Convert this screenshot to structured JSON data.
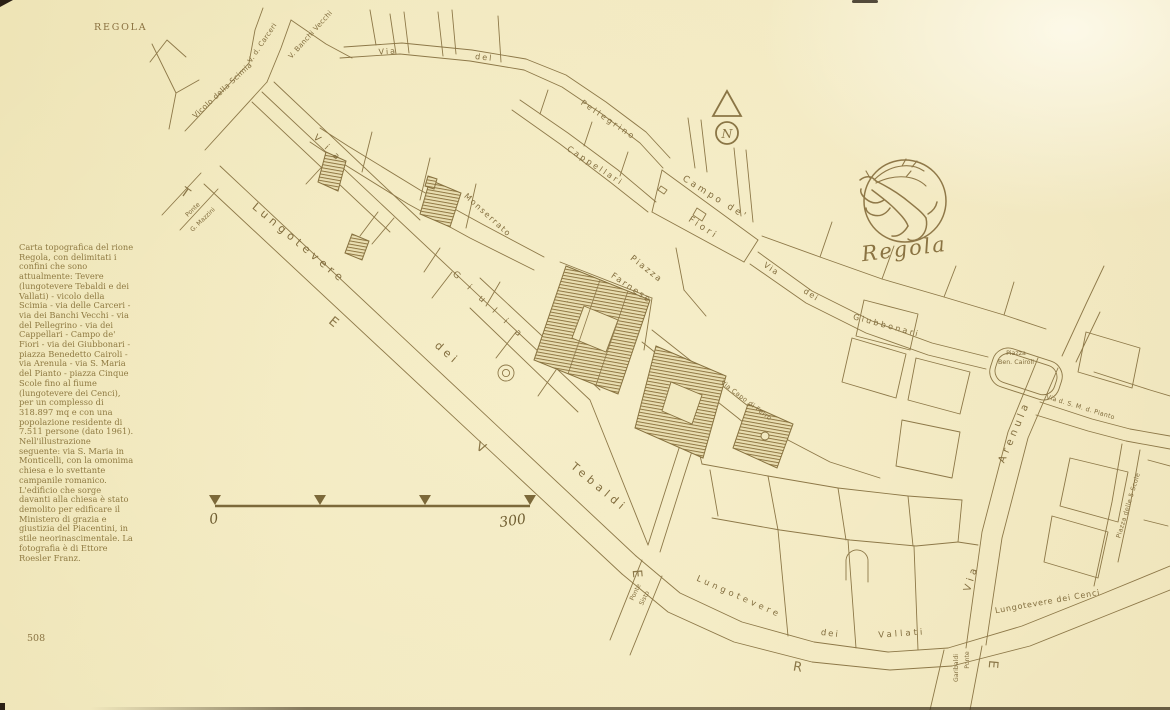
{
  "page": {
    "header": "REGOLA",
    "page_number": "508"
  },
  "sidebar": {
    "caption": "Carta topografica del rione Regola, con delimitati i confini che sono attualmente: Tevere (lungotevere Tebaldi e dei Vallati) - vicolo della Scimia - via delle Carceri - via dei Banchi Vecchi - via del Pellegrino - via dei Cappellari - Campo de' Fiori - via dei Giubbonari - piazza Benedetto Cairoli - via Arenula - via S. Maria del Pianto - piazza Cinque Scole fino al fiume (lungotevere dei Cenci), per un complesso di 318.897 mq e con una popolazione residente di 7.511 persone (dato 1961). Nell'illustrazione seguente: via S. Maria in Monticelli, con la omonima chiesa e lo svettante campanile romanico. L'edificio che sorge davanti alla chiesa è stato demolito per edificare il Ministero di grazia e giustizia del Piacentini, in stile neorinascimentale. La fotografia è di Ettore Roesler Franz."
  },
  "scale_bar": {
    "start_label": "0",
    "end_label": "300"
  },
  "compass": {
    "letter": "N"
  },
  "emblem": {
    "label": "Regola",
    "symbol": "rampant-stag"
  },
  "colors": {
    "paper": "#f2e9c0",
    "ink": "#8d7848",
    "text": "#8f7a42"
  },
  "map": {
    "labels": [
      {
        "text": "Vicolo della Scimia",
        "x": 224,
        "y": 92,
        "r": -43,
        "s": 7.5,
        "ls": 0.4
      },
      {
        "text": "V. d. Carceri",
        "x": 264,
        "y": 44,
        "r": -56,
        "s": 7,
        "ls": 0.3
      },
      {
        "text": "V. Banchi Vecchi",
        "x": 312,
        "y": 36,
        "r": -48,
        "s": 7,
        "ls": 0.3
      },
      {
        "text": "Via",
        "x": 388,
        "y": 54,
        "r": -4,
        "s": 8,
        "ls": 2
      },
      {
        "text": "del",
        "x": 484,
        "y": 60,
        "r": 6,
        "s": 8,
        "ls": 2
      },
      {
        "text": "Pellegrino",
        "x": 607,
        "y": 122,
        "r": 34,
        "s": 8,
        "ls": 2.5
      },
      {
        "text": "Cappellari",
        "x": 594,
        "y": 168,
        "r": 33,
        "s": 8,
        "ls": 2.5
      },
      {
        "text": "Monserrato",
        "x": 486,
        "y": 217,
        "r": 42,
        "s": 8,
        "ls": 1.5
      },
      {
        "text": "Via",
        "x": 328,
        "y": 152,
        "r": 43,
        "s": 9,
        "ls": 9
      },
      {
        "text": "Giulia",
        "x": 490,
        "y": 310,
        "r": 43,
        "s": 9,
        "ls": 13
      },
      {
        "text": "Campo de'",
        "x": 714,
        "y": 200,
        "r": 32,
        "s": 9,
        "ls": 3
      },
      {
        "text": "Fiori",
        "x": 702,
        "y": 230,
        "r": 33,
        "s": 9,
        "ls": 3
      },
      {
        "text": "Piazza",
        "x": 645,
        "y": 271,
        "r": 38,
        "s": 8.5,
        "ls": 2
      },
      {
        "text": "Farnese",
        "x": 630,
        "y": 290,
        "r": 34,
        "s": 8.5,
        "ls": 2
      },
      {
        "text": "Via",
        "x": 770,
        "y": 271,
        "r": 34,
        "s": 8,
        "ls": 1.5
      },
      {
        "text": "dei",
        "x": 810,
        "y": 297,
        "r": 32,
        "s": 8,
        "ls": 1.5
      },
      {
        "text": "Giubbonari",
        "x": 886,
        "y": 328,
        "r": 15,
        "s": 8,
        "ls": 2.5
      },
      {
        "text": "Via Capo di Ferro",
        "x": 745,
        "y": 402,
        "r": 37,
        "s": 6.5,
        "ls": 0.4
      },
      {
        "text": "Lungotevere",
        "x": 297,
        "y": 246,
        "r": 40,
        "s": 11,
        "ls": 4.5
      },
      {
        "text": "dei",
        "x": 445,
        "y": 356,
        "r": 41,
        "s": 11,
        "ls": 4
      },
      {
        "text": "Tebaldi",
        "x": 597,
        "y": 490,
        "r": 40,
        "s": 11,
        "ls": 4.5
      },
      {
        "text": "Lungotevere",
        "x": 738,
        "y": 599,
        "r": 24,
        "s": 8.5,
        "ls": 3.5
      },
      {
        "text": "dei",
        "x": 830,
        "y": 636,
        "r": 7,
        "s": 8.5,
        "ls": 2
      },
      {
        "text": "Vallati",
        "x": 902,
        "y": 636,
        "r": -4,
        "s": 8.5,
        "ls": 3
      },
      {
        "text": "Lungotevere dei Cenci",
        "x": 1048,
        "y": 604,
        "r": -10,
        "s": 8,
        "ls": 0.8
      },
      {
        "text": "Via",
        "x": 974,
        "y": 579,
        "r": -72,
        "s": 10,
        "ls": 4
      },
      {
        "text": "Arenula",
        "x": 1017,
        "y": 433,
        "r": -67,
        "s": 10,
        "ls": 4
      },
      {
        "text": "Via d. S. M. d. Pianto",
        "x": 1080,
        "y": 409,
        "r": 17,
        "s": 6.3,
        "ls": 0.3
      },
      {
        "text": "Piazza delle 5 Scole",
        "x": 1130,
        "y": 506,
        "r": -73,
        "s": 6.3,
        "ls": 0.3
      },
      {
        "text": "Piazza",
        "x": 1016,
        "y": 355,
        "r": 0,
        "s": 6.3,
        "cls": "tiny"
      },
      {
        "text": "Ben. Cairoli",
        "x": 1016,
        "y": 364,
        "r": 0,
        "s": 6.3,
        "cls": "tiny"
      },
      {
        "text": "Ponte",
        "x": 194,
        "y": 211,
        "r": -44,
        "s": 6.2,
        "cls": "tiny"
      },
      {
        "text": "G. Mazzini",
        "x": 204,
        "y": 221,
        "r": -44,
        "s": 6.2,
        "cls": "tiny"
      },
      {
        "text": "Ponte",
        "x": 637,
        "y": 593,
        "r": -64,
        "s": 6.2,
        "cls": "tiny"
      },
      {
        "text": "Sisto",
        "x": 646,
        "y": 599,
        "r": -64,
        "s": 6.2,
        "cls": "tiny"
      },
      {
        "text": "Ponte",
        "x": 969,
        "y": 660,
        "r": -90,
        "s": 6.2,
        "cls": "tiny"
      },
      {
        "text": "Garibaldi",
        "x": 958,
        "y": 668,
        "r": -90,
        "s": 6.2,
        "cls": "tiny"
      },
      {
        "text": "T",
        "x": 183,
        "y": 196,
        "r": 35,
        "cls": "river"
      },
      {
        "text": "E",
        "x": 331,
        "y": 325,
        "r": 40,
        "cls": "river"
      },
      {
        "text": "V",
        "x": 479,
        "y": 451,
        "r": 28,
        "cls": "river"
      },
      {
        "text": "E",
        "x": 633,
        "y": 574,
        "r": 85,
        "cls": "river"
      },
      {
        "text": "R",
        "x": 797,
        "y": 671,
        "r": 10,
        "cls": "river"
      },
      {
        "text": "E",
        "x": 989,
        "y": 664,
        "r": 95,
        "cls": "river"
      }
    ]
  }
}
